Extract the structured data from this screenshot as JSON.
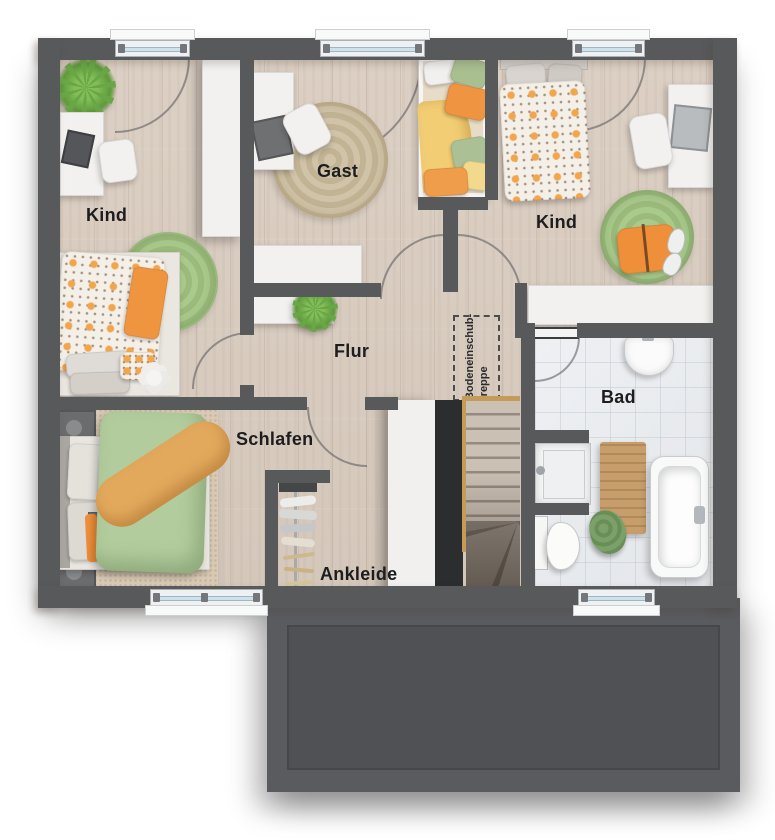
{
  "plan": {
    "room_labels": {
      "kind_left": "Kind",
      "gast": "Gast",
      "kind_right": "Kind",
      "flur": "Flur",
      "schlafen": "Schlafen",
      "ankleide": "Ankleide",
      "bad": "Bad"
    },
    "annotations": {
      "attic_stairs_line1": "Bodeneinschub-",
      "attic_stairs_line2": "treppe"
    }
  },
  "colors": {
    "wall": "#58595b",
    "wood_floor": "#d9cdc1",
    "bath_tile": "#e9ebee",
    "terrace": "#515257",
    "furniture_white": "#f2f1ef",
    "accent_orange": "#ef9441",
    "rug_green": "#a6c387",
    "rug_beige": "#ccbfa3",
    "bedding_green": "#b2cc9e",
    "bedding_yellow": "#f2cd74",
    "plant_green": "#69a746",
    "stair_rail": "#c49c57",
    "window_glass": "#cfe2ec",
    "stairwell_void": "#2c2d2f"
  }
}
